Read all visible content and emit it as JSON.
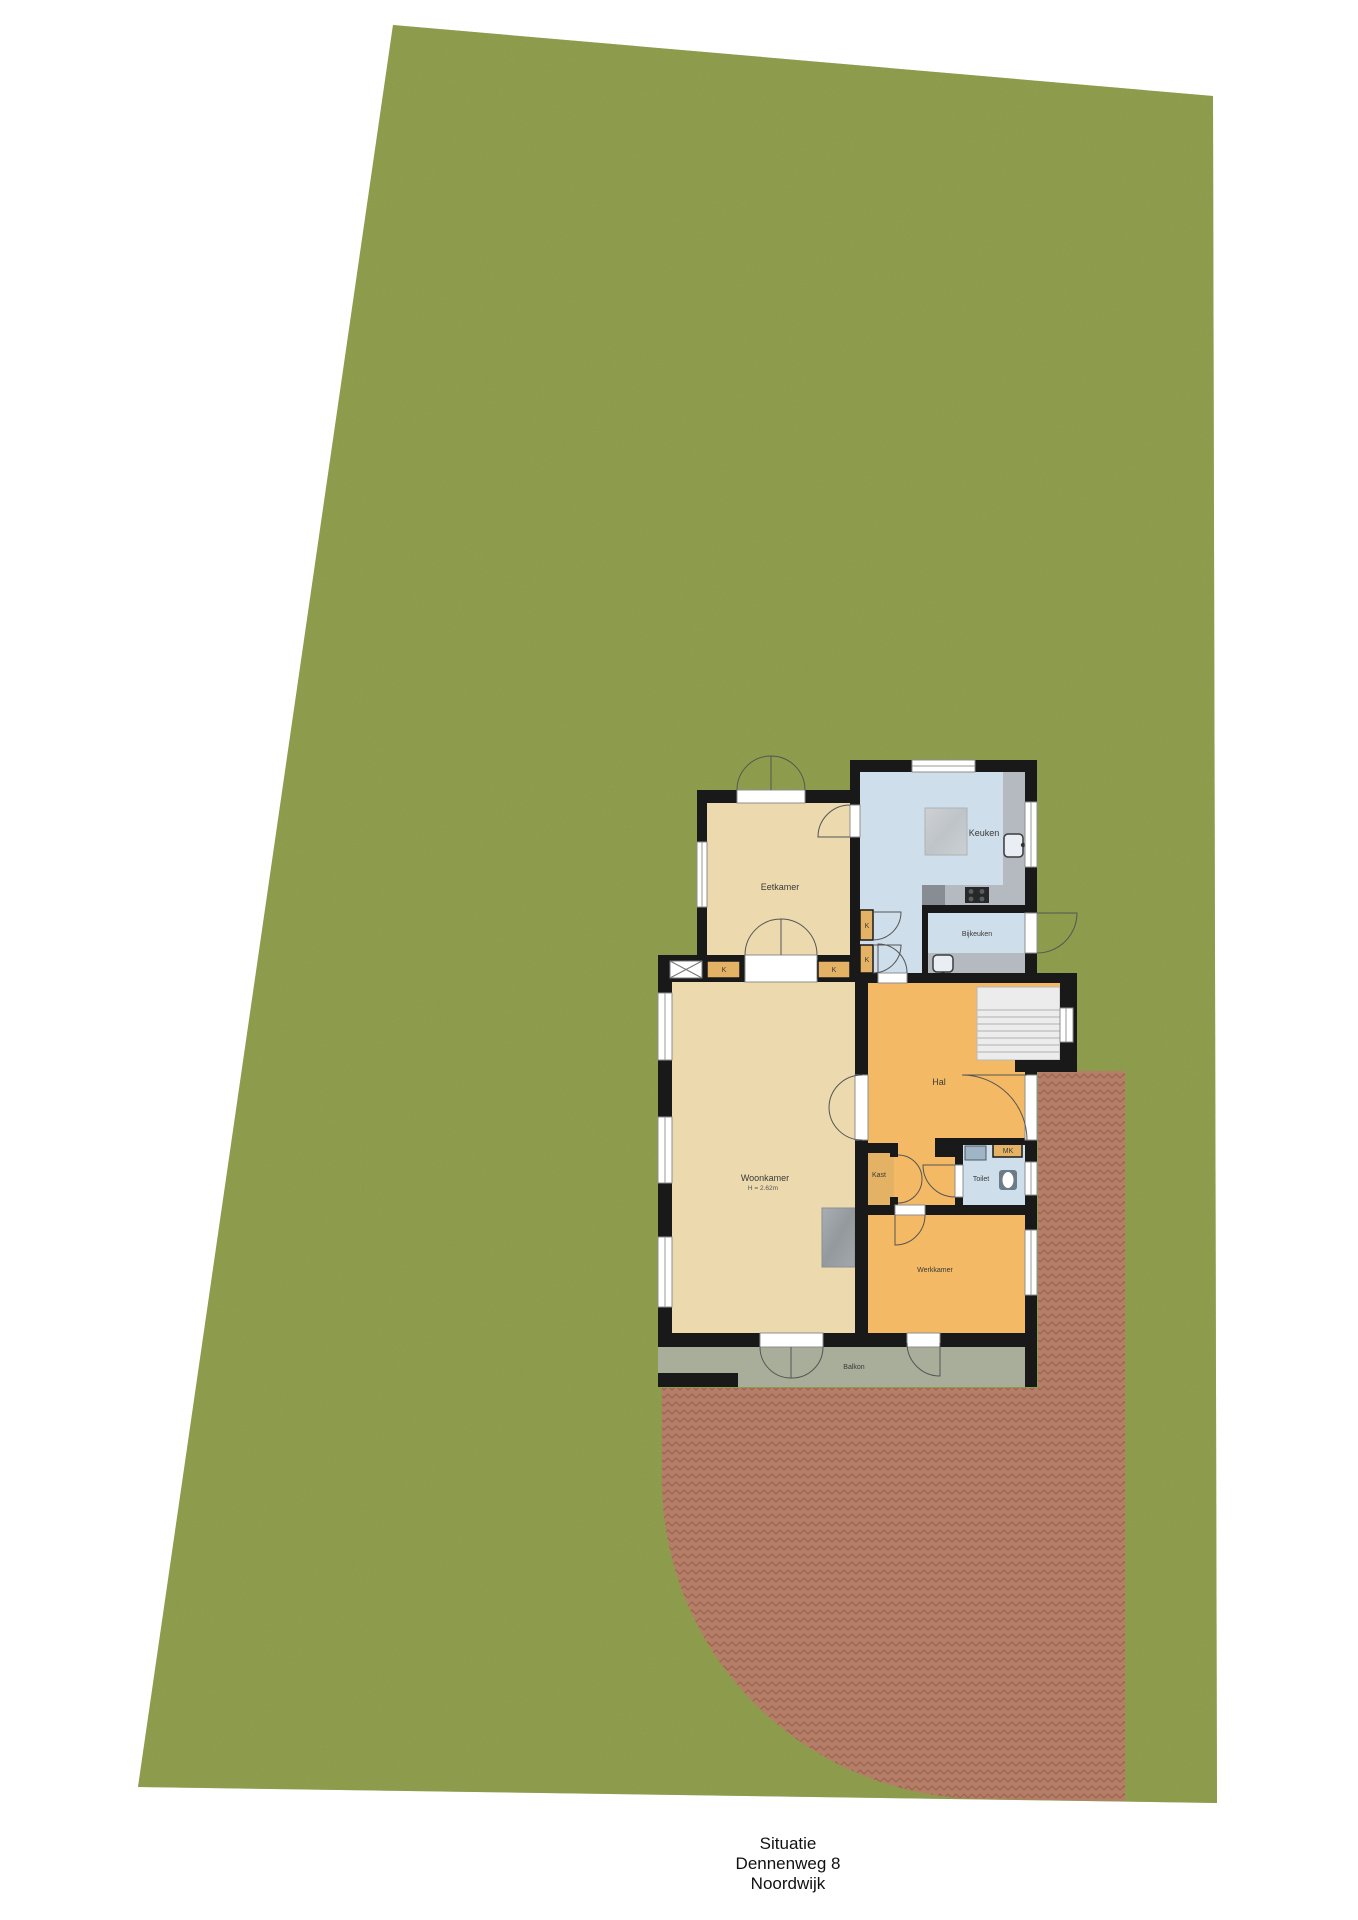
{
  "title_block": {
    "line1": "Situatie",
    "line2": "Dennenweg 8",
    "line3": "Noordwijk"
  },
  "rooms": {
    "eetkamer": "Eetkamer",
    "keuken": "Keuken",
    "bijkeuken": "Bijkeuken",
    "woonkamer": "Woonkamer",
    "woonkamer_height": "H = 2.62m",
    "hal": "Hal",
    "toilet": "Toilet",
    "kast": "Kast",
    "meterkast": "MK",
    "werkkamer": "Werkkamer",
    "balkon": "Balkon"
  },
  "cabinet_labels": {
    "k1": "K",
    "k2": "K",
    "k3": "K",
    "k4": "K"
  },
  "colors": {
    "page": "#ffffff",
    "grass": "#8a9b47",
    "brick_base": "#b67d69",
    "brick_line": "#9d5c49",
    "wall": "#191919",
    "floor_living": "#ecd9ae",
    "floor_kitchen": "#cfdeeb",
    "floor_hall": "#f3b964",
    "cabinet": "#e4b264",
    "balcony": "#a9ae9b",
    "stairs": "#ececec",
    "counter": "#b4bac0",
    "island": "#c6cacd",
    "appliance": "#878d92",
    "stove": "#26282a",
    "fireplace": "#9ba1a6",
    "window_fill": "#ffffff",
    "door_arc": "#555555",
    "label_text": "#3a3a3a",
    "title_text": "#111111"
  }
}
